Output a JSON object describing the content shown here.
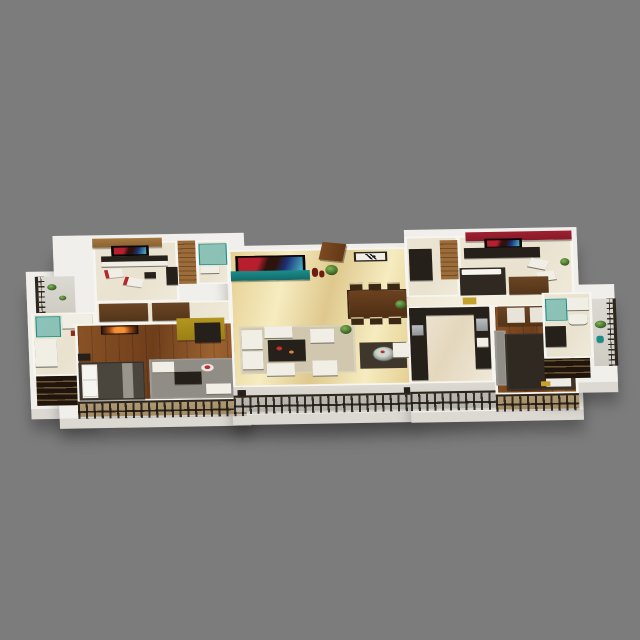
{
  "scene": {
    "type": "3d-floor-plan-render",
    "view": "isometric-from-front",
    "description": "Wide single-storey apartment 3D floor plan floating on a flat gray backdrop with a soft ground shadow: central marble living-dining room with wall TV and teal console, left wing with study, hallway closets and master bedroom, right wing with red-accent bedroom, kitchen and second bedroom, bathrooms at both outer ends, front balconies with dark metal railings on a white plinth"
  },
  "rooms": [
    {
      "name": "living-dining-room"
    },
    {
      "name": "study-lounge-left"
    },
    {
      "name": "staircase-left"
    },
    {
      "name": "ensuite-bath-left-small"
    },
    {
      "name": "hallway-closets-left"
    },
    {
      "name": "master-bedroom-left"
    },
    {
      "name": "bathroom-far-left"
    },
    {
      "name": "side-balcony-left"
    },
    {
      "name": "front-balcony-left"
    },
    {
      "name": "front-balcony-center"
    },
    {
      "name": "entrance-foyer-right"
    },
    {
      "name": "staircase-right"
    },
    {
      "name": "bedroom-right-red-wall"
    },
    {
      "name": "kitchen"
    },
    {
      "name": "utility-balcony-kitchen"
    },
    {
      "name": "bedroom-far-right"
    },
    {
      "name": "front-balcony-right"
    },
    {
      "name": "bathroom-far-right"
    },
    {
      "name": "side-balcony-right"
    }
  ],
  "furniture": [
    "wall-tv-living",
    "teal-tv-console",
    "decor-vases",
    "entry-door-ajar",
    "eagle-wall-art",
    "dining-table-six-chairs",
    "modular-white-sofa",
    "dark-coffee-table",
    "white-poufs",
    "beige-area-rug",
    "round-glass-table-with-rose",
    "white-armchair",
    "potted-plants",
    "study-desk",
    "red-white-swivel-chairs",
    "study-wall-tv",
    "wood-staircase",
    "glass-shower",
    "closet-wardrobes",
    "sunset-wall-art",
    "double-bed-white-gray",
    "lounge-chairs-gray-rug",
    "red-wall-tv",
    "work-desk",
    "white-chaise-chairs",
    "platform-bed-dark",
    "mirror-wardrobe",
    "kitchen-counters-dark",
    "steel-sink",
    "steel-hob",
    "wash-basin",
    "toilet",
    "teal-shower-enclosure",
    "storage-shelf-dark",
    "balcony-metal-railings",
    "white-plinth-base"
  ],
  "colors": {
    "bg": "#7c7c7c",
    "plinth": "#f1efeb",
    "plinthFace": "#dcd9d3",
    "wall": "#f7f5f0",
    "cream": "#e9e2cf",
    "marbleA": "#e5d093",
    "marbleB": "#f6ecc0",
    "marbleC": "#dfc88d",
    "marbleLightA": "#efe8d5",
    "marbleLightB": "#f6f1e2",
    "wood": "#8a5226",
    "woodDark": "#6e3e1b",
    "woodHi": "#9c6231",
    "deckA": "#c9b189",
    "deckB": "#b89c72",
    "concrete": "#dcd9d2",
    "concreteB": "#cfccc4",
    "tileA": "#efe8d8",
    "tileB": "#e4d7bd",
    "tanWall": "#a5783f",
    "redWall": "#9e2030",
    "yellowWall": "#b3961e",
    "teal": "#1c8d8b",
    "tealDark": "#126a69",
    "tealGlass": "rgba(45,160,156,0.5)",
    "railing": "#2c251c",
    "railingBar": "rgba(25,20,14,0.85)",
    "sofa": "#f1eee6",
    "sofaBase": "#7a756a",
    "darkFurn": "#26201a",
    "brownFurn": "#6b4523",
    "brownFurnDark": "#53351a",
    "rugGray": "#908d86",
    "rugBeige": "#d0c7ae",
    "rugDark": "#3f362c",
    "green": "#83b357",
    "greenMid": "#46722d",
    "greenDark": "#24441a",
    "steelA": "#b9bec0",
    "steelB": "#8f9496",
    "door": "#7c4a22",
    "mattress": "#edebe3",
    "blanket": "#4b463d",
    "blanketDark": "#2f2922",
    "tvScreenA": "#b81f2e",
    "tvScreenB": "#2e130c",
    "tvScreenC": "#1c2f74",
    "tvScreenD": "#4ab5c6",
    "artOrangeA": "#f59036",
    "artOrangeB": "#a14c12",
    "artOrangeC": "#2c130a",
    "redAccent": "#b5252b",
    "seatBeige": "#d9c69c",
    "stairA": "#9c6c3a",
    "stairB": "#744d24",
    "shelfA": "#1f150c",
    "shelfB": "#6d5534",
    "woodTableA": "#6b4220",
    "woodTableB": "#4f2e13",
    "shadow": "rgba(22,22,22,0.55)"
  }
}
